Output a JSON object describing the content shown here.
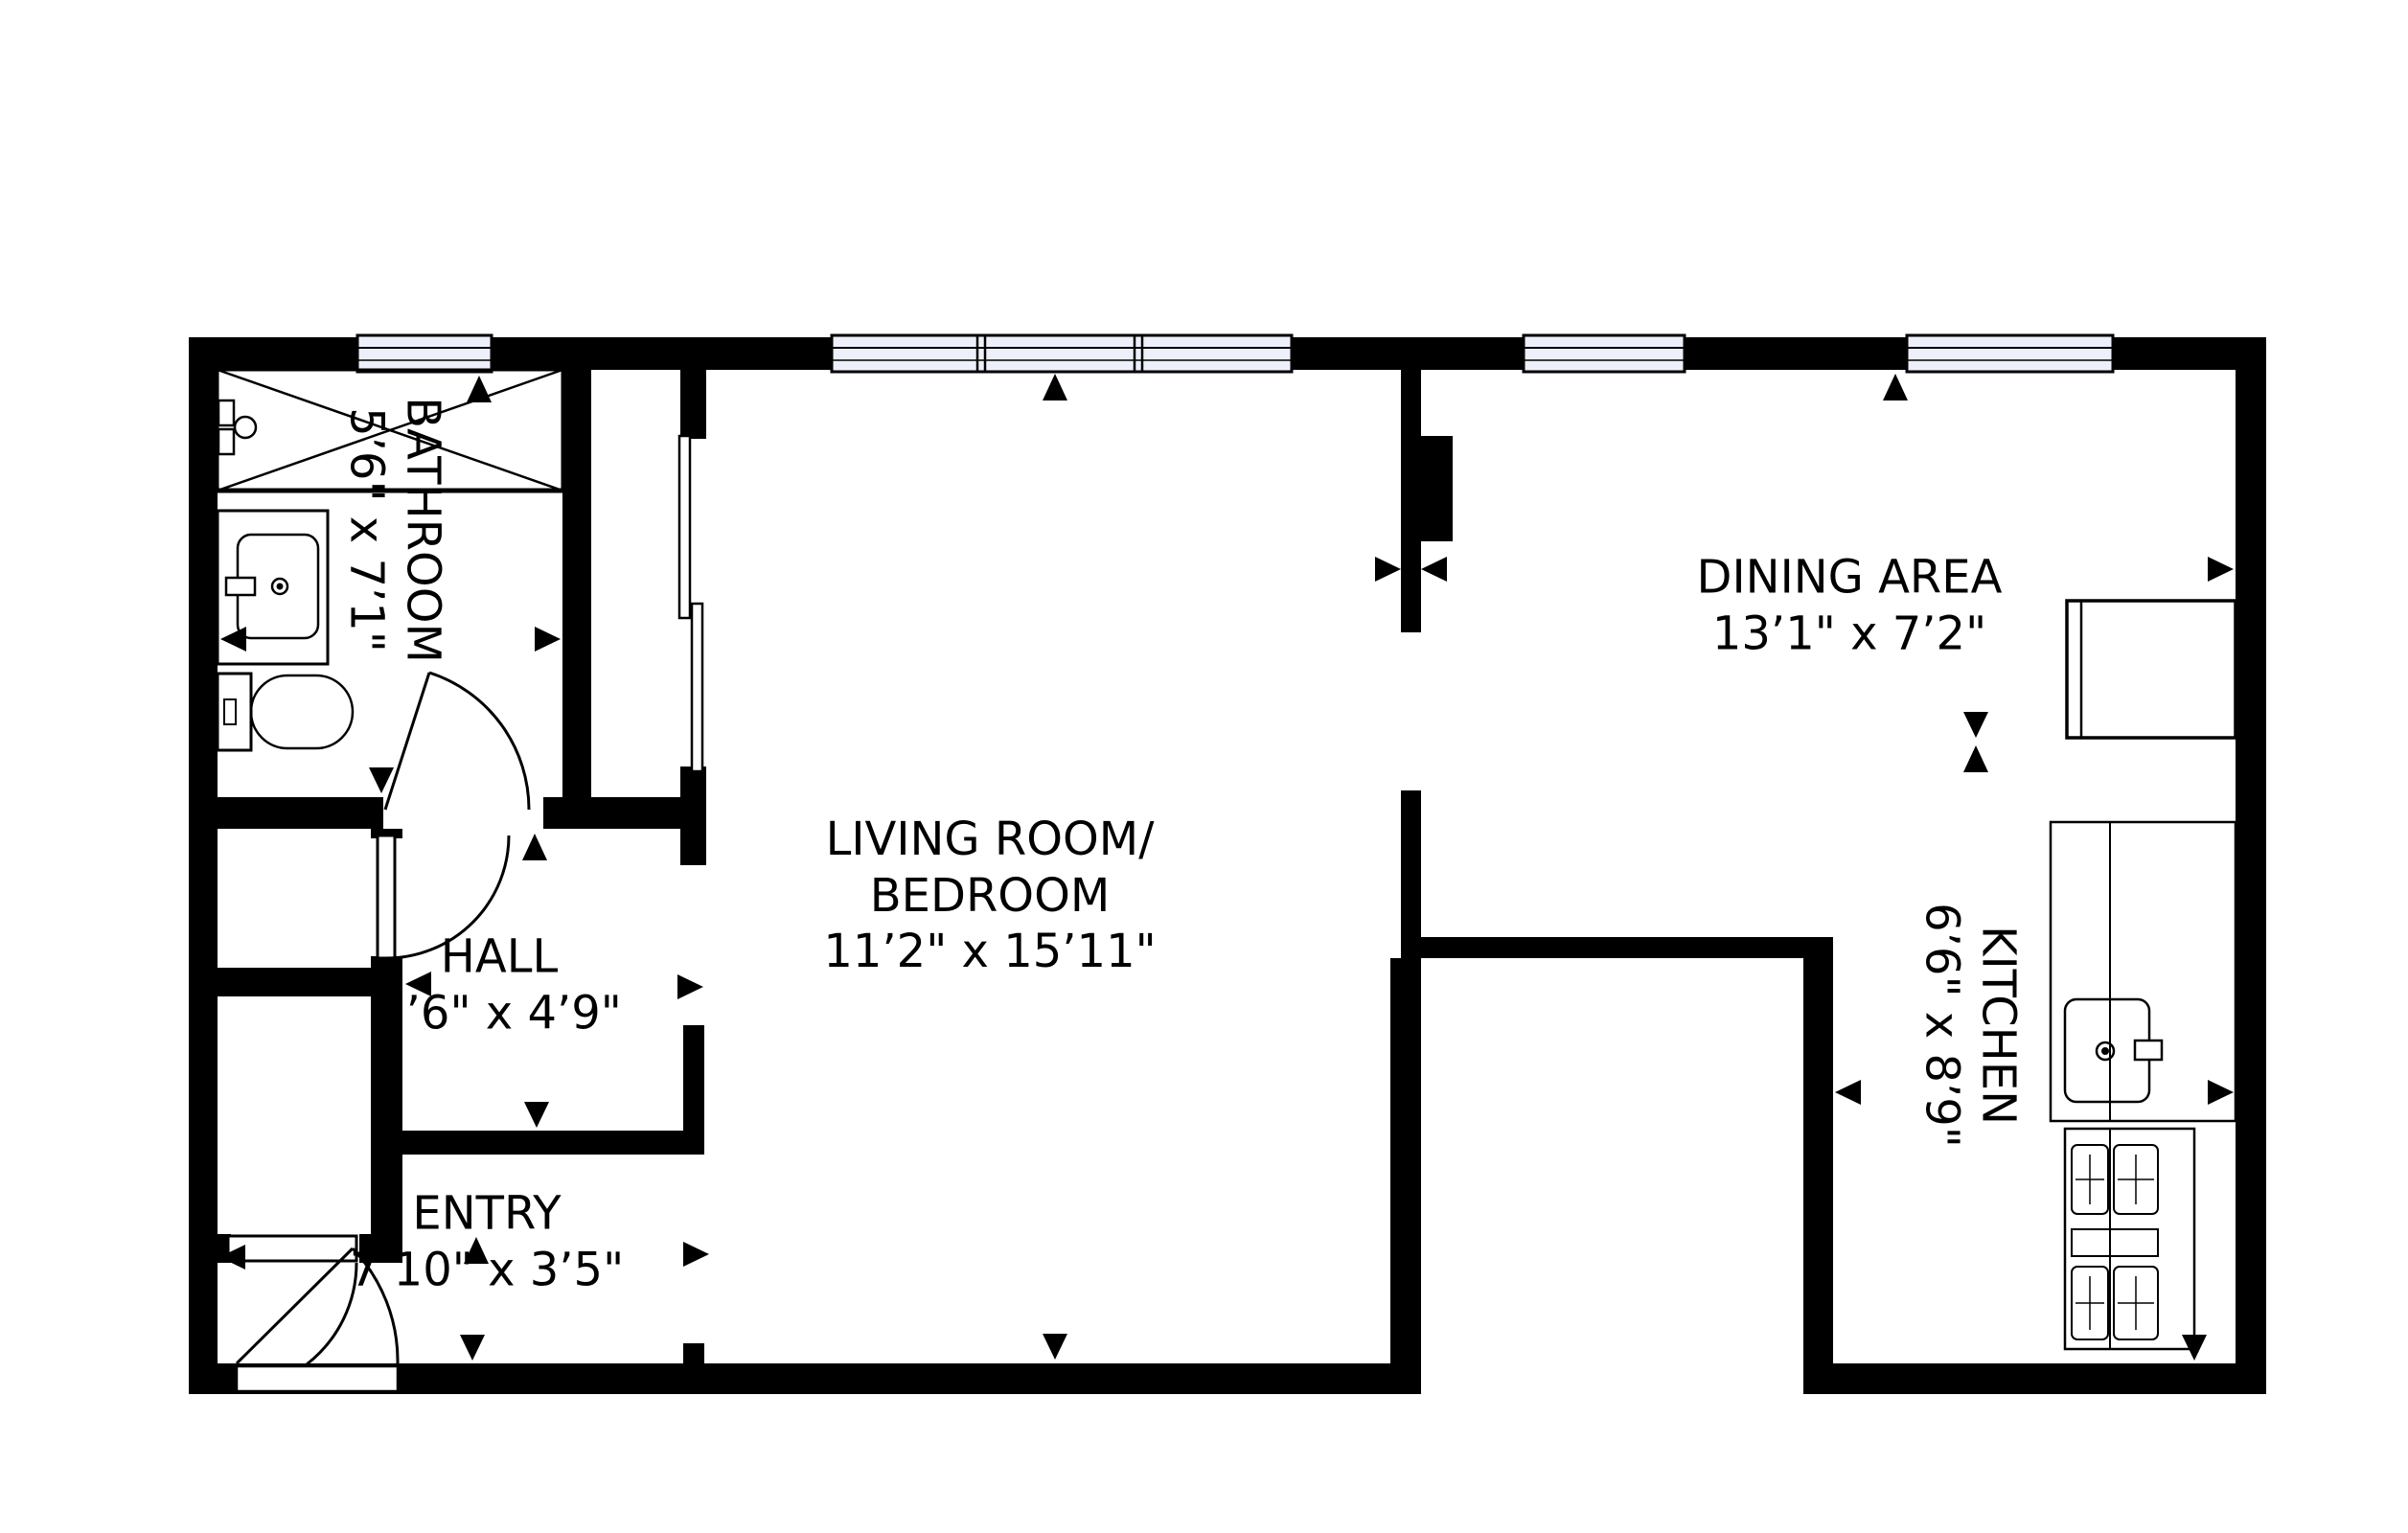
{
  "plan": {
    "type": "apartment-floor-plan",
    "background": "#ffffff",
    "wall_color": "#000000",
    "window_fill": "#edeffa",
    "rooms": [
      {
        "id": "bathroom",
        "name": "BATHROOM",
        "dims": "5’6\" x 7’1\"",
        "label_rotated": true
      },
      {
        "id": "hall",
        "name": "HALL",
        "dims": "5’6\" x 4’9\"",
        "label_rotated": false
      },
      {
        "id": "entry",
        "name": "ENTRY",
        "dims": "7’10\" x 3’5\"",
        "label_rotated": false
      },
      {
        "id": "living-bedroom",
        "name": "LIVING ROOM/\nBEDROOM",
        "dims": "11’2\" x 15’11\"",
        "label_rotated": false
      },
      {
        "id": "dining-area",
        "name": "DINING AREA",
        "dims": "13’1\" x 7’2\"",
        "label_rotated": false
      },
      {
        "id": "kitchen",
        "name": "KITCHEN",
        "dims": "6’6\" x 8’9\"",
        "label_rotated": true
      }
    ],
    "fixtures": [
      "shower",
      "shower-valve",
      "bathroom-sink-vanity",
      "toilet",
      "sliding-closet-door",
      "hinged-doors",
      "refrigerator",
      "kitchen-counter",
      "kitchen-sink",
      "stove-4-burner"
    ],
    "window_units": 4
  }
}
